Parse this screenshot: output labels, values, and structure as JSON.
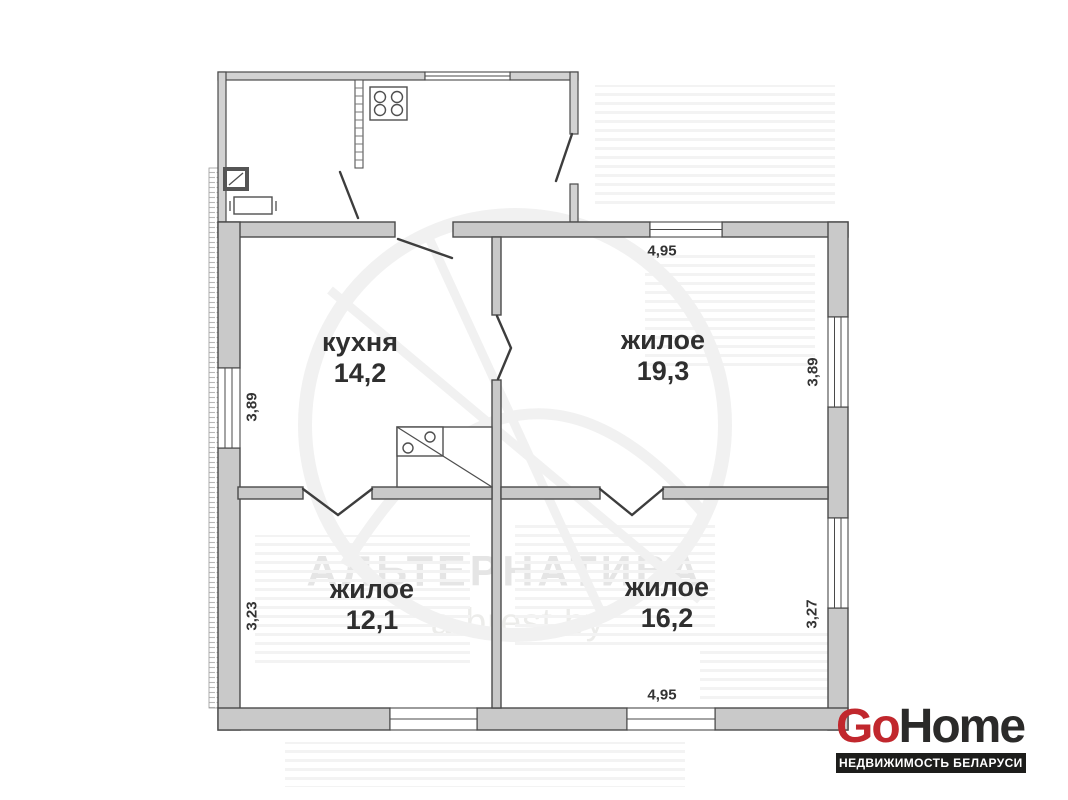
{
  "plan": {
    "rooms": [
      {
        "id": "kitchen",
        "name": "кухня",
        "area": "14,2"
      },
      {
        "id": "living-1",
        "name": "жилое",
        "area": "19,3"
      },
      {
        "id": "living-2",
        "name": "жилое",
        "area": "12,1"
      },
      {
        "id": "living-3",
        "name": "жилое",
        "area": "16,2"
      }
    ],
    "dimensions": [
      {
        "id": "top-width",
        "value": "4,95"
      },
      {
        "id": "left-upper-height",
        "value": "3,89"
      },
      {
        "id": "right-upper-height",
        "value": "3,89"
      },
      {
        "id": "left-lower-height",
        "value": "3,23"
      },
      {
        "id": "right-lower-height",
        "value": "3,27"
      },
      {
        "id": "bottom-width",
        "value": "4,95"
      }
    ],
    "icons": {
      "stove_burners": "stove-burners-icon",
      "kitchen_furnace": "furnace-icon",
      "flue": "flue-icon",
      "bench": "bench-icon",
      "door_swing": "door-swing-icon"
    }
  },
  "watermark": {
    "title": "АЛЬТЕРНАТИВА",
    "site": "a-brest.by"
  },
  "logo": {
    "brand_part1": "Go",
    "brand_part2": "Home",
    "tagline": "НЕДВИЖИМОСТЬ БЕЛАРУСИ"
  },
  "theme": {
    "wall_fill": "#c9c9c9",
    "wall_outline": "#4a4a4a",
    "label_color": "#2f2f2f",
    "dim_color": "#333333",
    "watermark_title_color": "#e5e5e5",
    "watermark_site_color": "#ececea",
    "logo_red": "#c1272d",
    "logo_dark": "#2b2a29",
    "logo_bar_bg": "#1d1d1b"
  }
}
